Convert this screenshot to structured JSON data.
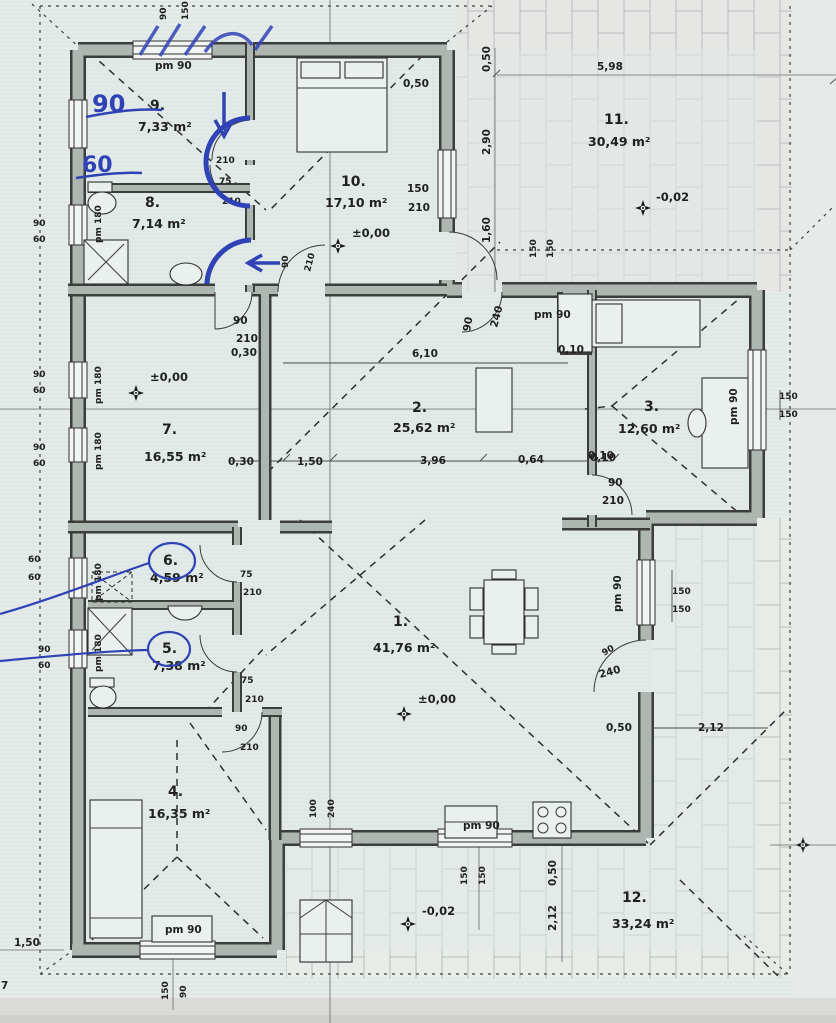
{
  "document": {
    "kind": "house-ground-floor-plan"
  },
  "rooms": [
    {
      "number": "1.",
      "area": "41,76 m²",
      "level": "±0,00"
    },
    {
      "number": "2.",
      "area": "25,62 m²"
    },
    {
      "number": "3.",
      "area": "12,60 m²"
    },
    {
      "number": "4.",
      "area": "16,35 m²"
    },
    {
      "number": "5.",
      "area": "7,38 m²"
    },
    {
      "number": "6.",
      "area": "4,59 m²"
    },
    {
      "number": "7.",
      "area": "16,55 m²",
      "level": "±0,00"
    },
    {
      "number": "8.",
      "area": "7,14 m²"
    },
    {
      "number": "9.",
      "area": "7,33 m²"
    },
    {
      "number": "10.",
      "area": "17,10 m²",
      "level": "±0,00"
    },
    {
      "number": "11.",
      "area": "30,49 m²",
      "level": "-0,02"
    },
    {
      "number": "12.",
      "area": "33,24 m²",
      "level": "-0,02"
    }
  ],
  "labels": {
    "pm90": "pm 90",
    "pm180": "pm 180",
    "n90": "90",
    "n60": "60",
    "n75": "75",
    "n100": "100",
    "n150": "150",
    "n210": "210",
    "n240": "240",
    "d050": "0,50",
    "d010": "0,10",
    "d030": "0,30",
    "d064": "0,64",
    "d150": "1,50",
    "d160": "1,60",
    "d180": "1,80",
    "d212": "2,12",
    "d290": "2,90",
    "d396": "3,96",
    "d598": "5,98",
    "d610": "6,10",
    "d7": "7",
    "lvl0": "±0,00",
    "lvlm": "-0,02"
  },
  "annotations": {
    "hw90": "90",
    "hw60": "60"
  }
}
